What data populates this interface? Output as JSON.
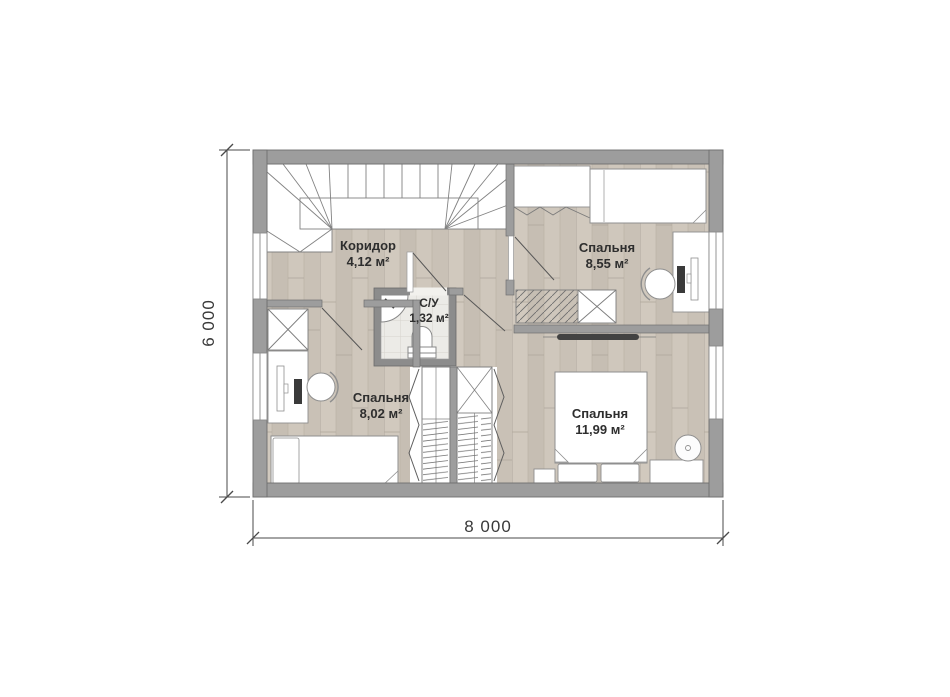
{
  "rooms": {
    "corridor": {
      "label": "Коридор",
      "area": "4,12 м²"
    },
    "bedroom_top_right": {
      "label": "Спальня",
      "area": "8,55 м²"
    },
    "bathroom": {
      "label": "С/У",
      "area": "1,32 м²"
    },
    "bedroom_left": {
      "label": "Спальня",
      "area": "8,02 м²"
    },
    "bedroom_bottom_right": {
      "label": "Спальня",
      "area": "11,99 м²"
    }
  },
  "dimensions": {
    "width_label": "8 000",
    "height_label": "6 000"
  },
  "colors": {
    "wall": "#9d9d9d",
    "wall_outline": "#6f6f6f",
    "bathroom_wall": "#8c8c8c",
    "floor_wood": "#ccc4b9",
    "floor_tile": "#ecebe7",
    "label_text": "#2e2e2e",
    "dimension_text": "#3a3a3a"
  }
}
